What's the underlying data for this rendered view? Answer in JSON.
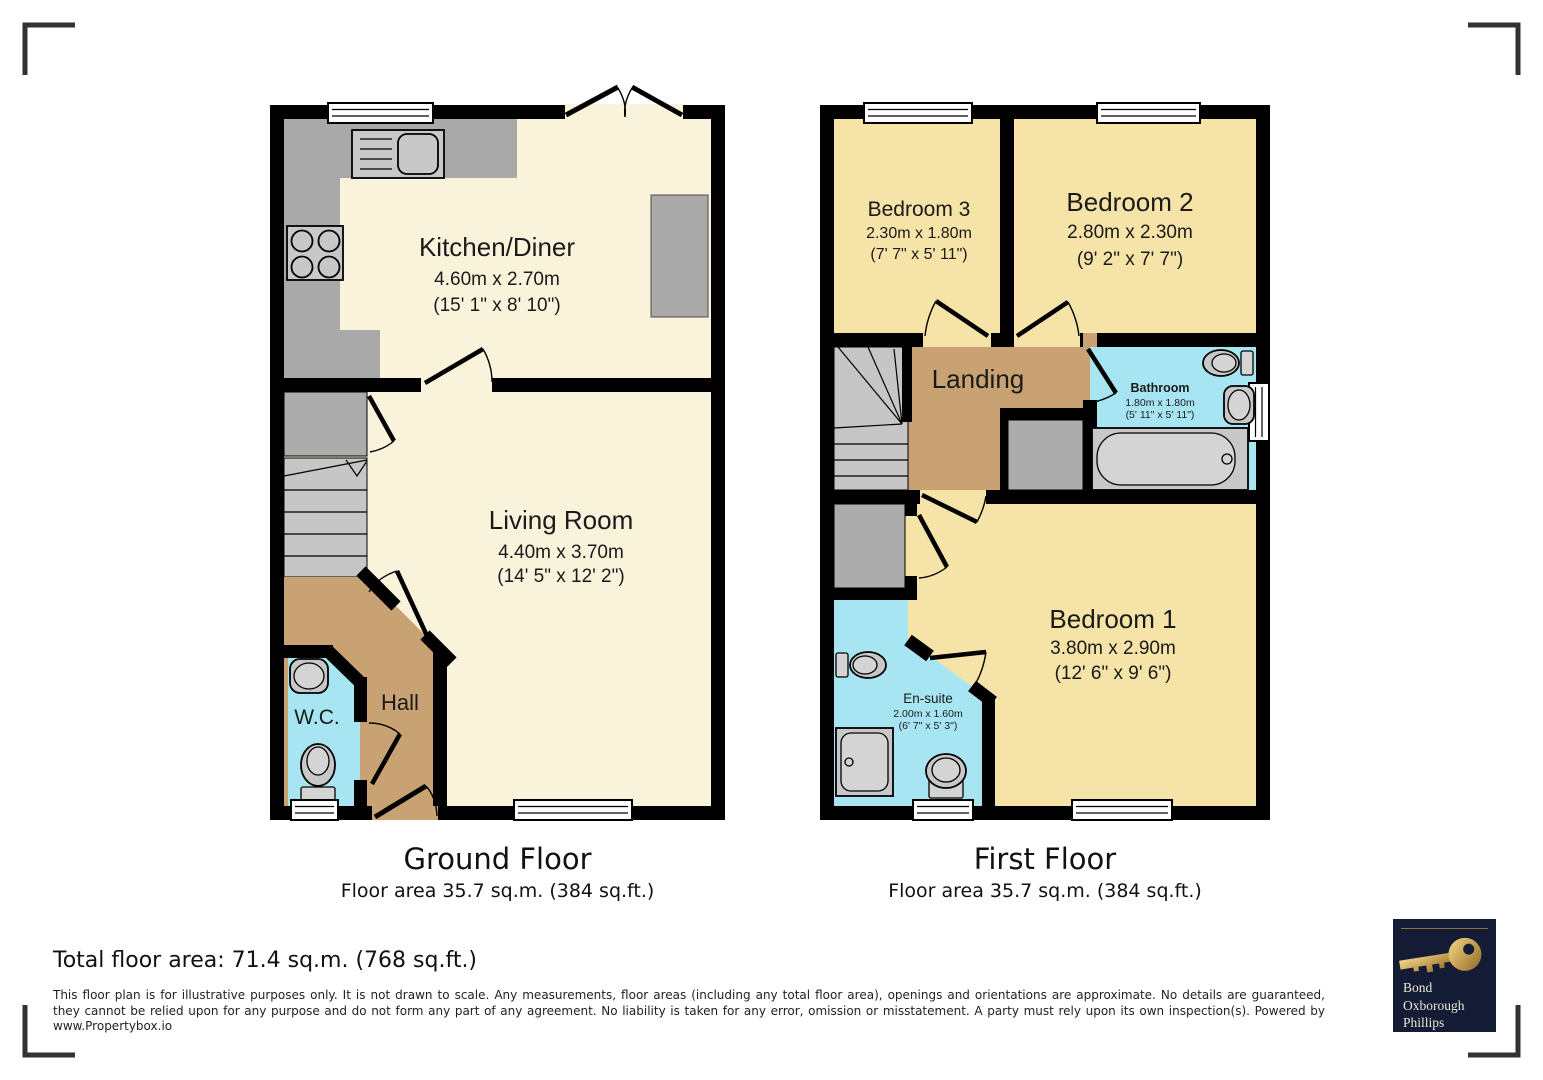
{
  "ground_floor": {
    "title": "Ground Floor",
    "area_label": "Floor area 35.7 sq.m. (384 sq.ft.)",
    "rooms": {
      "kitchen_diner": {
        "name": "Kitchen/Diner",
        "metric": "4.60m x 2.70m",
        "imperial": "(15' 1\" x 8' 10\")"
      },
      "living_room": {
        "name": "Living Room",
        "metric": "4.40m x 3.70m",
        "imperial": "(14' 5\" x 12' 2\")"
      },
      "hall": {
        "name": "Hall"
      },
      "wc": {
        "name": "W.C."
      }
    }
  },
  "first_floor": {
    "title": "First Floor",
    "area_label": "Floor area 35.7 sq.m. (384 sq.ft.)",
    "rooms": {
      "bedroom_3": {
        "name": "Bedroom 3",
        "metric": "2.30m x 1.80m",
        "imperial": "(7' 7\" x 5' 11\")"
      },
      "bedroom_2": {
        "name": "Bedroom 2",
        "metric": "2.80m x 2.30m",
        "imperial": "(9' 2\" x 7' 7\")"
      },
      "landing": {
        "name": "Landing"
      },
      "bathroom": {
        "name": "Bathroom",
        "metric": "1.80m x 1.80m",
        "imperial": "(5' 11\" x 5' 11\")"
      },
      "bedroom_1": {
        "name": "Bedroom 1",
        "metric": "3.80m x 2.90m",
        "imperial": "(12' 6\" x 9' 6\")"
      },
      "en_suite": {
        "name": "En-suite",
        "metric": "2.00m x 1.60m",
        "imperial": "(6' 7\" x 5' 3\")"
      }
    }
  },
  "footer": {
    "total_area": "Total floor area: 71.4 sq.m. (768 sq.ft.)",
    "disclaimer_line1": "This floor plan is for illustrative purposes only. It is not drawn to scale. Any measurements, floor areas (including any total floor area), openings and orientations are approximate. No details are guaranteed,",
    "disclaimer_line2": "they cannot be relied upon for any purpose and do not form any part of any agreement. No liability is taken for any error, omission or misstatement. A party must rely upon its own inspection(s). Powered by",
    "disclaimer_line3": "www.Propertybox.io"
  },
  "logo": {
    "line1": "Bond",
    "line2": "Oxborough",
    "line3": "Phillips"
  },
  "colors": {
    "walls": "#000000",
    "living_floor": "#FAF3DC",
    "bedroom_floor": "#F6E3A7",
    "hall_landing_floor": "#C8A273",
    "wet_room_floor": "#A8E5F2",
    "stairs_counters": "#C6C6C6",
    "logo_background": "#131B35",
    "logo_gold": "#C19A4C",
    "corner_marks": "#333333"
  }
}
